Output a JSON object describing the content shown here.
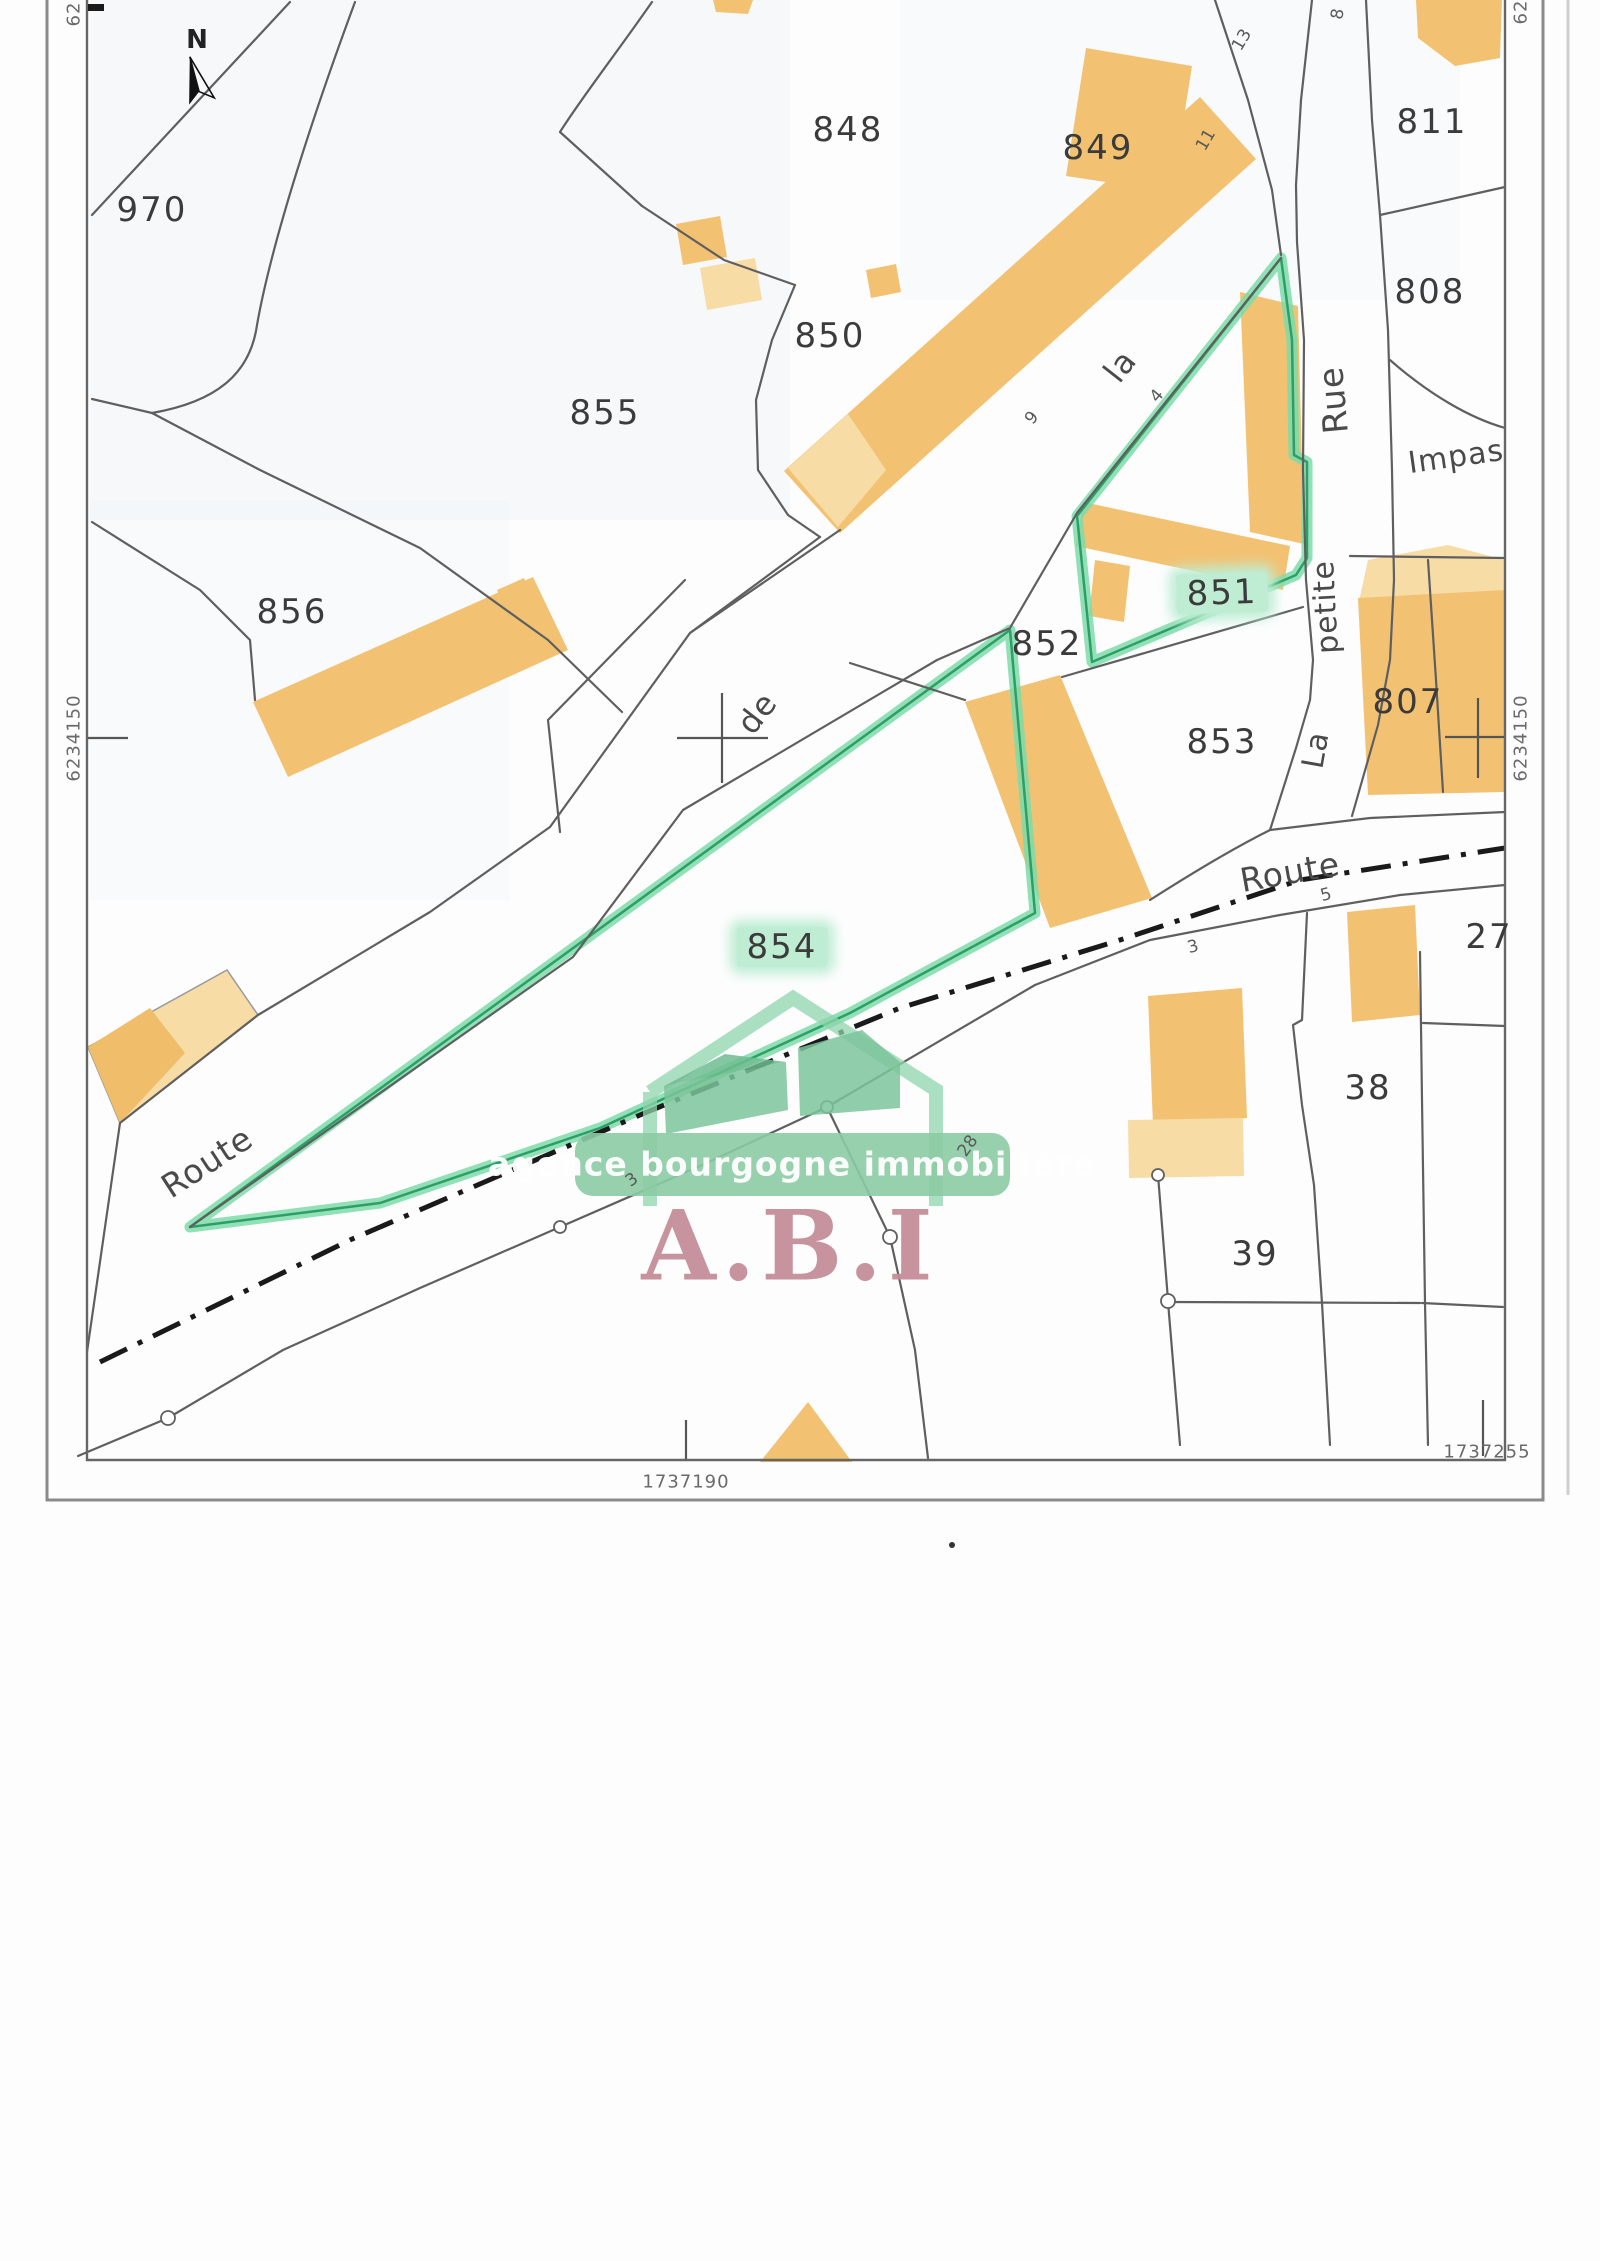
{
  "page": {
    "width": 1600,
    "height": 2261
  },
  "colors": {
    "building": "#F2C272",
    "building_light": "#F7DCA6",
    "highlight_band": "#7EDAA9",
    "highlight_line": "#2E9E68",
    "label_highlight": "#BEEDD4",
    "parcel_line": "#5f5f5f",
    "frame": "#8a8a8a",
    "text": "#3b3b3b",
    "logo_green": "#8CCBA4",
    "logo_green_dark": "#6FBC90",
    "logo_pink": "#C28B98"
  },
  "north": {
    "label": "N"
  },
  "logo": {
    "tagline": "agence bourgogne immobilière",
    "acronym": "A.B.I"
  },
  "parcel_labels": [
    {
      "id": "970",
      "text": "970",
      "x": 152,
      "y": 210,
      "r": 0,
      "hl": false
    },
    {
      "id": "848",
      "text": "848",
      "x": 848,
      "y": 130,
      "r": 0,
      "hl": false
    },
    {
      "id": "849",
      "text": "849",
      "x": 1098,
      "y": 148,
      "r": 0,
      "hl": false
    },
    {
      "id": "850",
      "text": "850",
      "x": 830,
      "y": 336,
      "r": 0,
      "hl": false
    },
    {
      "id": "855",
      "text": "855",
      "x": 605,
      "y": 413,
      "r": 0,
      "hl": false
    },
    {
      "id": "856",
      "text": "856",
      "x": 292,
      "y": 612,
      "r": 0,
      "hl": false
    },
    {
      "id": "811",
      "text": "811",
      "x": 1432,
      "y": 122,
      "r": 0,
      "hl": false
    },
    {
      "id": "808",
      "text": "808",
      "x": 1430,
      "y": 292,
      "r": 0,
      "hl": false
    },
    {
      "id": "851",
      "text": "851",
      "x": 1222,
      "y": 593,
      "r": -2,
      "hl": true
    },
    {
      "id": "852",
      "text": "852",
      "x": 1047,
      "y": 644,
      "r": 0,
      "hl": false
    },
    {
      "id": "853",
      "text": "853",
      "x": 1222,
      "y": 742,
      "r": 0,
      "hl": false
    },
    {
      "id": "807",
      "text": "807",
      "x": 1408,
      "y": 702,
      "r": 0,
      "hl": false
    },
    {
      "id": "854",
      "text": "854",
      "x": 782,
      "y": 947,
      "r": 0,
      "hl": true
    },
    {
      "id": "27",
      "text": "27",
      "x": 1489,
      "y": 937,
      "r": 0,
      "hl": false
    },
    {
      "id": "38",
      "text": "38",
      "x": 1368,
      "y": 1088,
      "r": 0,
      "hl": false
    },
    {
      "id": "39",
      "text": "39",
      "x": 1255,
      "y": 1254,
      "r": 0,
      "hl": false
    }
  ],
  "street_labels": [
    {
      "id": "route-1",
      "text": "Route",
      "x": 207,
      "y": 1162,
      "r": -33,
      "s": 33
    },
    {
      "id": "de",
      "text": "de",
      "x": 757,
      "y": 713,
      "r": -52,
      "s": 32
    },
    {
      "id": "la",
      "text": "la",
      "x": 1120,
      "y": 366,
      "r": -52,
      "s": 32
    },
    {
      "id": "rue",
      "text": "Rue",
      "x": 1334,
      "y": 400,
      "r": -95,
      "s": 34
    },
    {
      "id": "petite",
      "text": "petite",
      "x": 1326,
      "y": 607,
      "r": -93,
      "s": 30
    },
    {
      "id": "la-2",
      "text": "La",
      "x": 1316,
      "y": 750,
      "r": -80,
      "s": 30
    },
    {
      "id": "route-2",
      "text": "Route",
      "x": 1290,
      "y": 872,
      "r": -10,
      "s": 33
    },
    {
      "id": "impasse",
      "text": "Impas",
      "x": 1456,
      "y": 457,
      "r": -8,
      "s": 30
    }
  ],
  "house_numbers": [
    {
      "id": "hn-13",
      "text": "13",
      "x": 1242,
      "y": 40,
      "r": -60
    },
    {
      "id": "hn-11",
      "text": "11",
      "x": 1206,
      "y": 140,
      "r": -60
    },
    {
      "id": "hn-8",
      "text": "8",
      "x": 1338,
      "y": 14,
      "r": -80
    },
    {
      "id": "hn-9",
      "text": "9",
      "x": 1032,
      "y": 418,
      "r": -50
    },
    {
      "id": "hn-4",
      "text": "4",
      "x": 1157,
      "y": 396,
      "r": -50
    },
    {
      "id": "hn-5",
      "text": "5",
      "x": 1326,
      "y": 895,
      "r": -15
    },
    {
      "id": "hn-3",
      "text": "3",
      "x": 1193,
      "y": 947,
      "r": -15
    },
    {
      "id": "hn-3b",
      "text": "3",
      "x": 632,
      "y": 1180,
      "r": -35
    },
    {
      "id": "hn-28",
      "text": "28",
      "x": 968,
      "y": 1146,
      "r": -55
    }
  ],
  "grid_labels": [
    {
      "id": "northing-left",
      "text": "6234150",
      "x": 74,
      "y": 738,
      "r": -90
    },
    {
      "id": "northing-right",
      "text": "6234150",
      "x": 1521,
      "y": 738,
      "r": -90
    },
    {
      "id": "northing-topleft",
      "text": "62",
      "x": 74,
      "y": 14,
      "r": -90
    },
    {
      "id": "northing-topright",
      "text": "62",
      "x": 1521,
      "y": 12,
      "r": -90
    },
    {
      "id": "easting-1737190",
      "text": "1737190",
      "x": 686,
      "y": 1482,
      "r": 0
    },
    {
      "id": "easting-1737255",
      "text": "1737255",
      "x": 1487,
      "y": 1452,
      "r": 0
    }
  ]
}
